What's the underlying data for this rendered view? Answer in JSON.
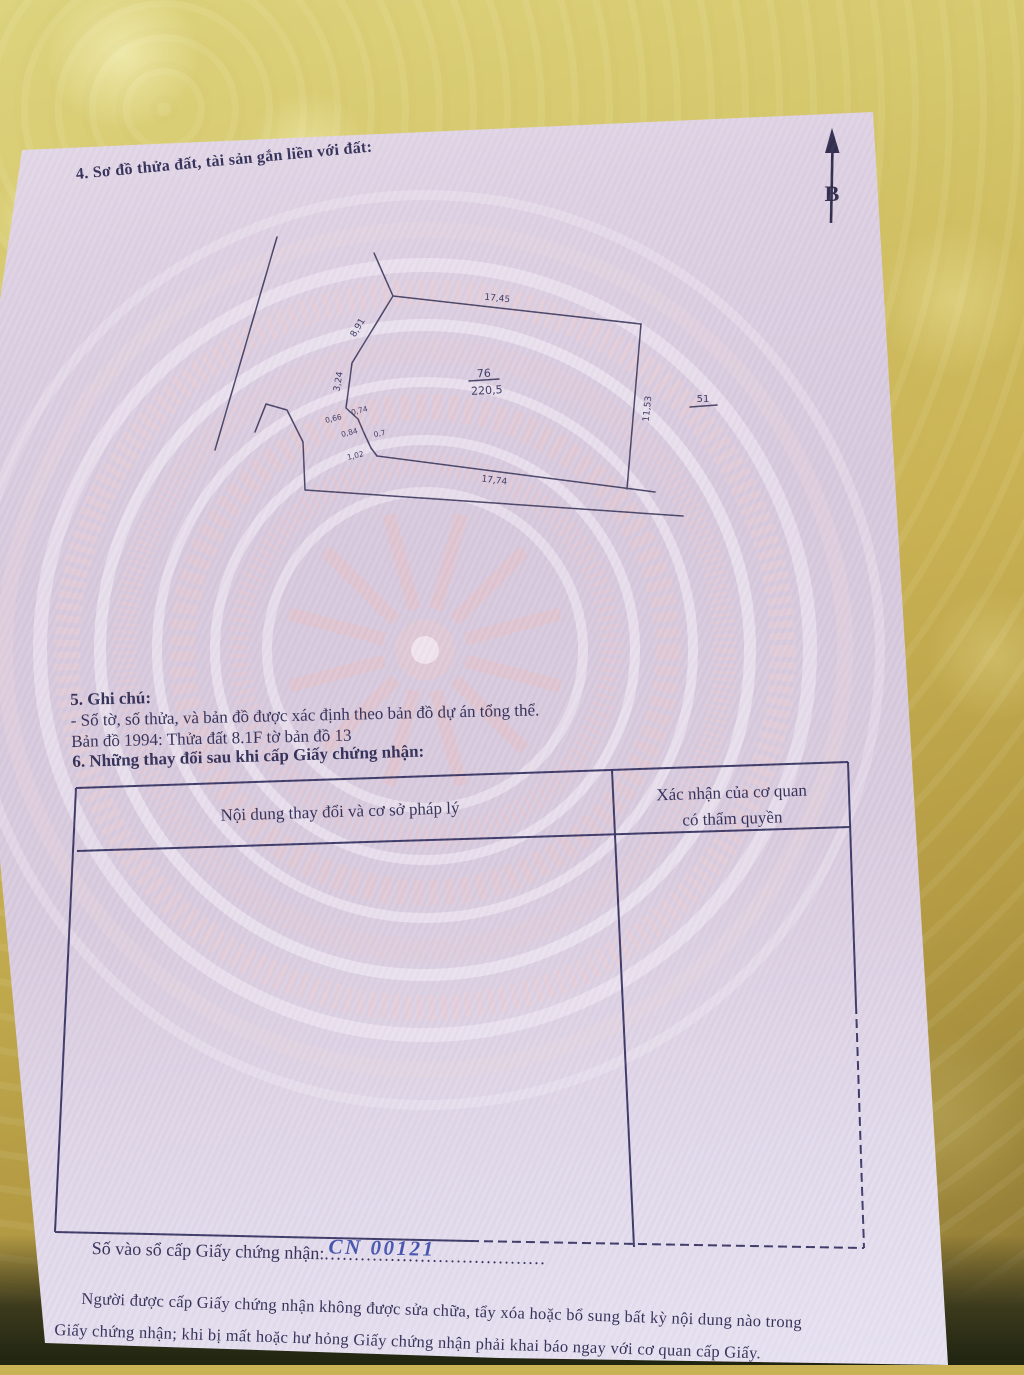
{
  "document": {
    "section4_heading": "4. Sơ đồ thửa đất, tài sản gắn liền với đất:",
    "north_arrow_label": "B",
    "diagram": {
      "parcel_number": "76",
      "parcel_area": "220,5",
      "adjacent_parcel_number": "51",
      "edge_top": "17,45",
      "edge_upper_left": "8,91",
      "edge_left": "3,24",
      "edge_right": "11,53",
      "edge_bottom": "17,74",
      "edge_small_1": "0,66",
      "edge_small_2": "0,74",
      "edge_small_3": "0,84",
      "edge_small_4": "0,7",
      "edge_small_5": "1,02"
    },
    "section5": {
      "heading": "5. Ghi chú:",
      "note1": "- Số tờ, số thửa, và bản đồ được xác định theo bản đồ dự án tổng thể.",
      "note2": "Bản đồ 1994: Thửa đất 8.1F tờ bản đồ 13"
    },
    "section6": {
      "heading": "6. Những thay đổi sau khi cấp Giấy chứng nhận:",
      "col1_header": "Nội dung thay đổi và cơ sở pháp lý",
      "col2_header_line1": "Xác nhận của cơ quan",
      "col2_header_line2": "có thẩm quyền"
    },
    "registry": {
      "label": "Số vào sổ cấp Giấy chứng nhận:",
      "number": "CN 00121",
      "dots": "....................................."
    },
    "footer": {
      "line1": "Người được cấp Giấy chứng nhận không được sửa chữa, tẩy xóa hoặc bổ sung bất kỳ nội dung nào trong",
      "line2": "Giấy chứng nhận; khi bị mất hoặc hư hỏng Giấy chứng nhận phải khai báo ngay với cơ quan cấp Giấy."
    }
  },
  "colors": {
    "paper": "#d8cbde",
    "fabric_yellow": "#c9b254",
    "ink": "#312e57",
    "handwriting_blue": "#4353ae",
    "diagram_line": "#474366"
  }
}
